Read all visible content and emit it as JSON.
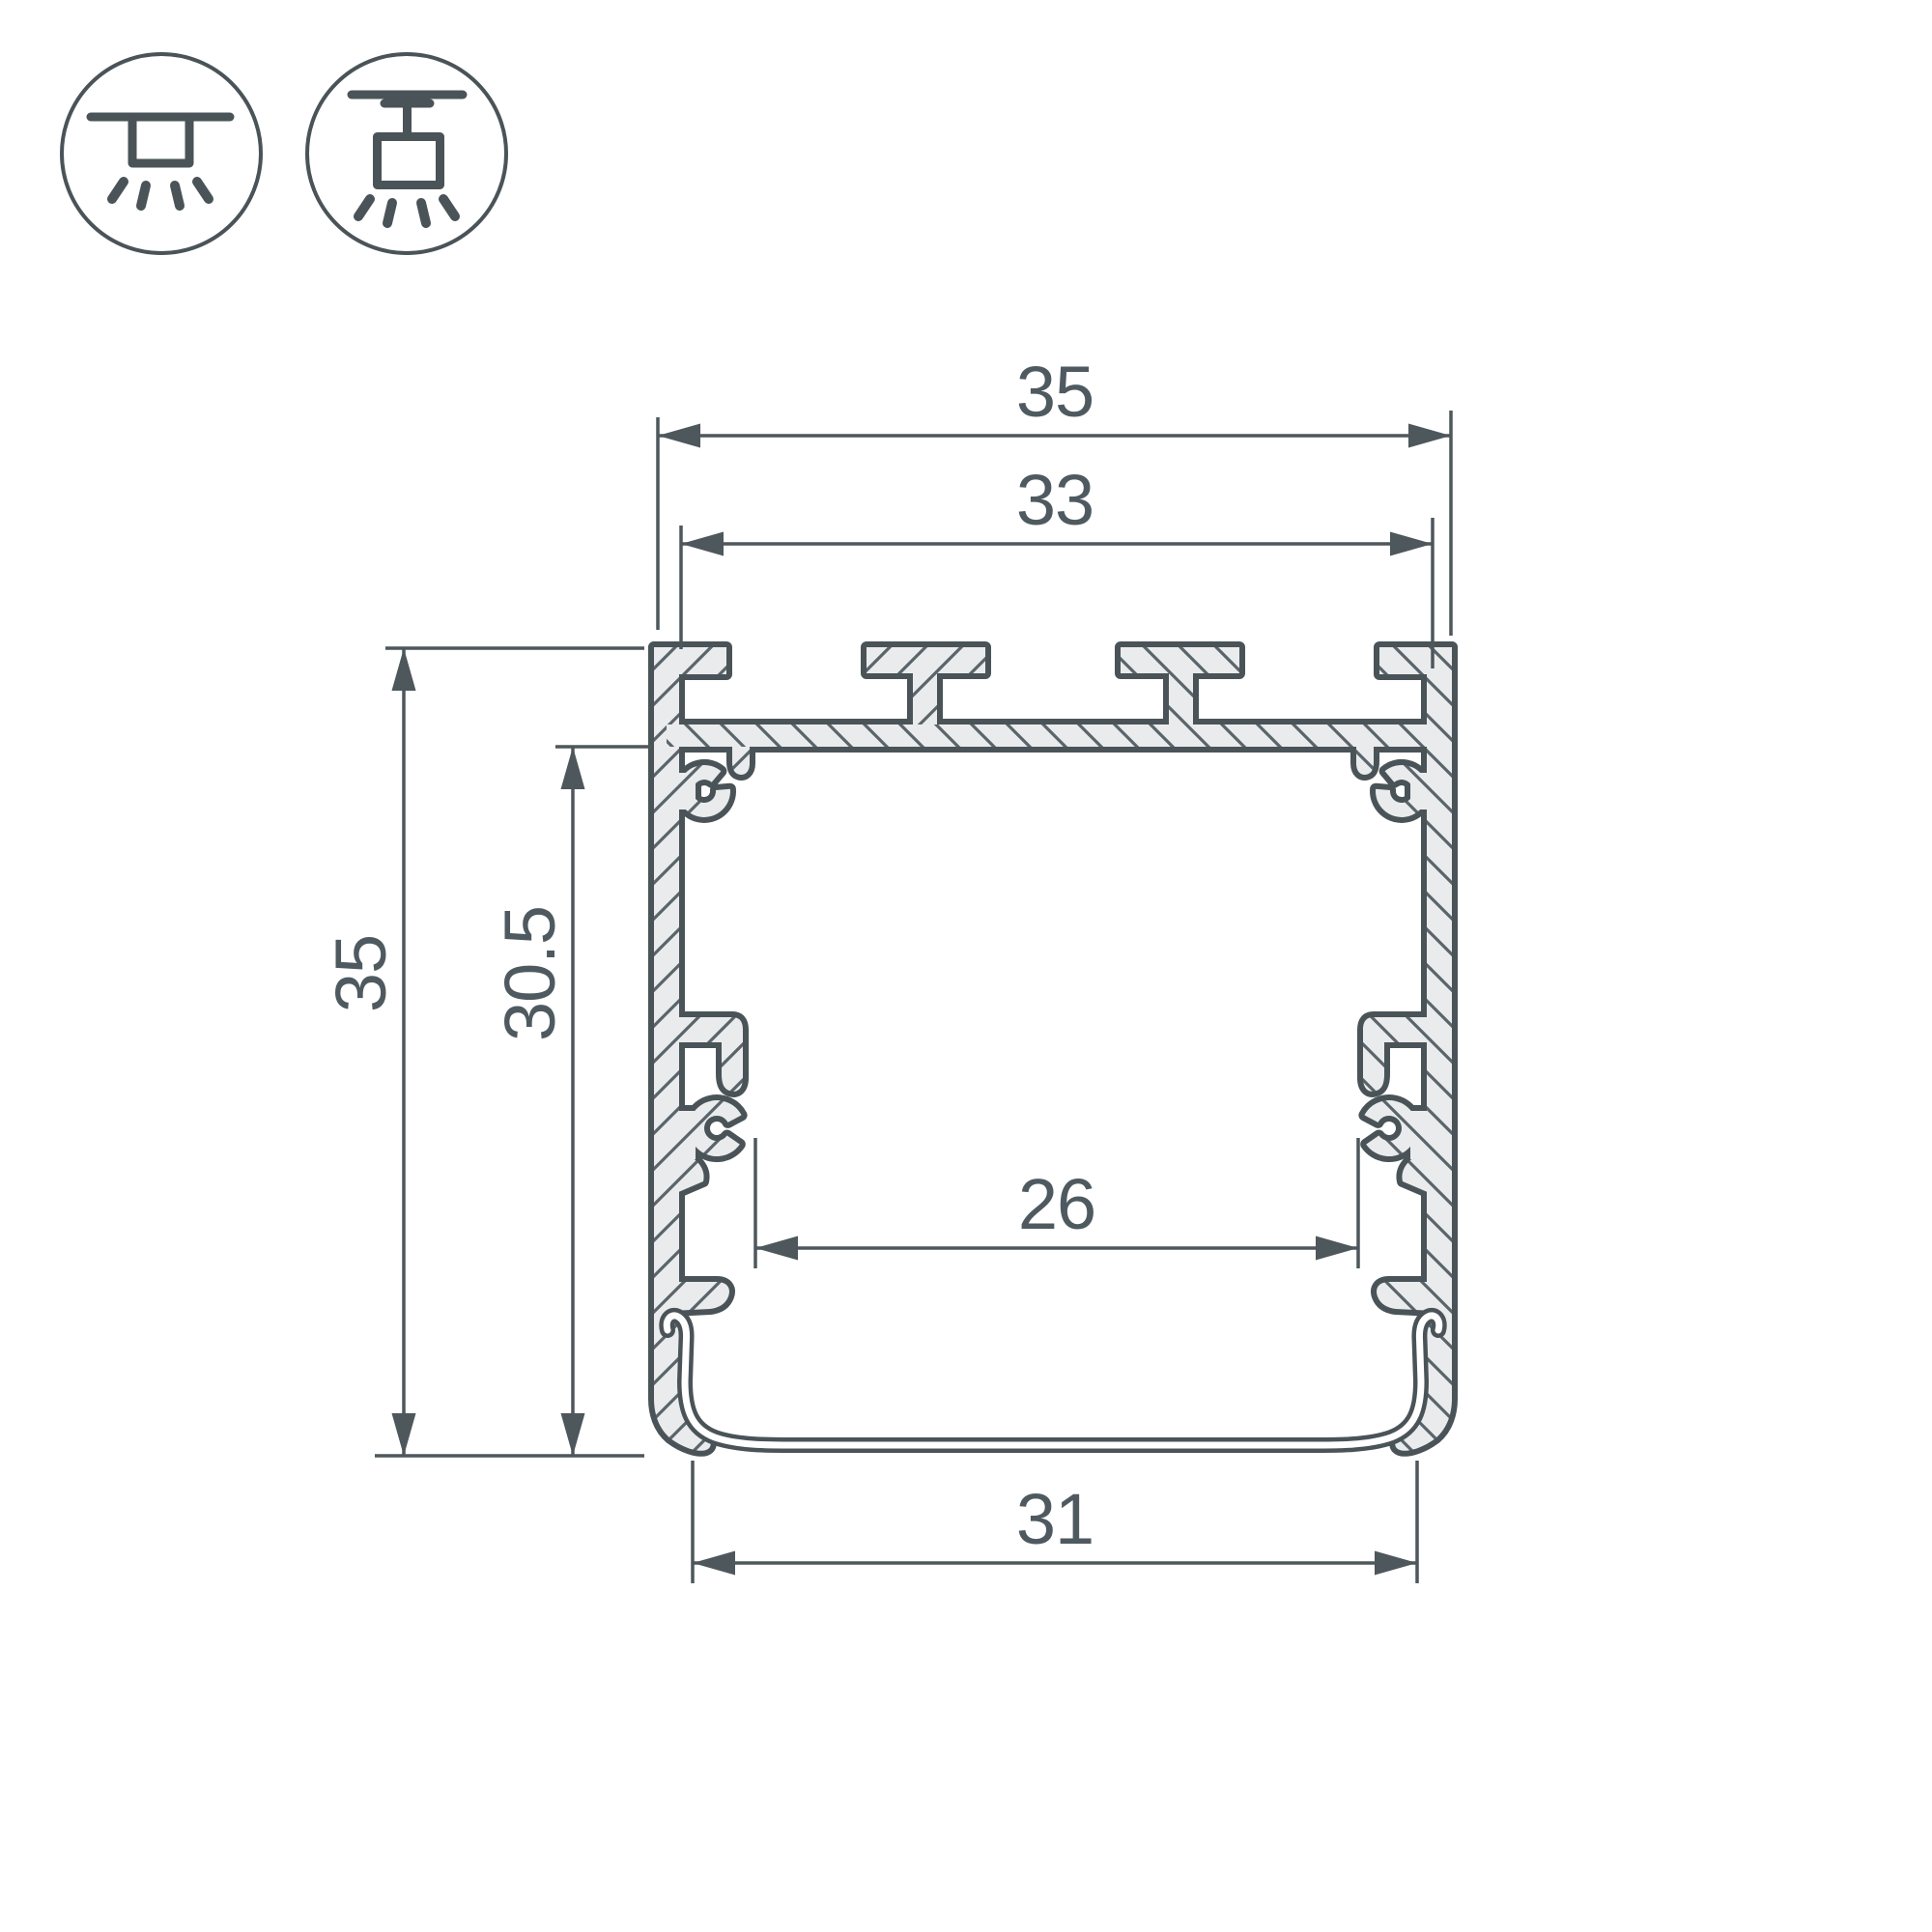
{
  "drawing": {
    "title": "LED aluminium profile cross-section technical drawing",
    "dimensions": {
      "outer_width": "35",
      "top_slot_width": "33",
      "outer_height": "35",
      "inner_height": "30.5",
      "inner_width": "26",
      "bottom_width": "31"
    },
    "icons": [
      {
        "name": "surface-mount-icon"
      },
      {
        "name": "pendant-mount-icon"
      }
    ],
    "colors": {
      "line": "#4a5458",
      "dimension_text": "#4f5a60",
      "hatch_fill": "#e9ebec",
      "hatch_line": "#5a646a",
      "background": "#ffffff"
    }
  }
}
